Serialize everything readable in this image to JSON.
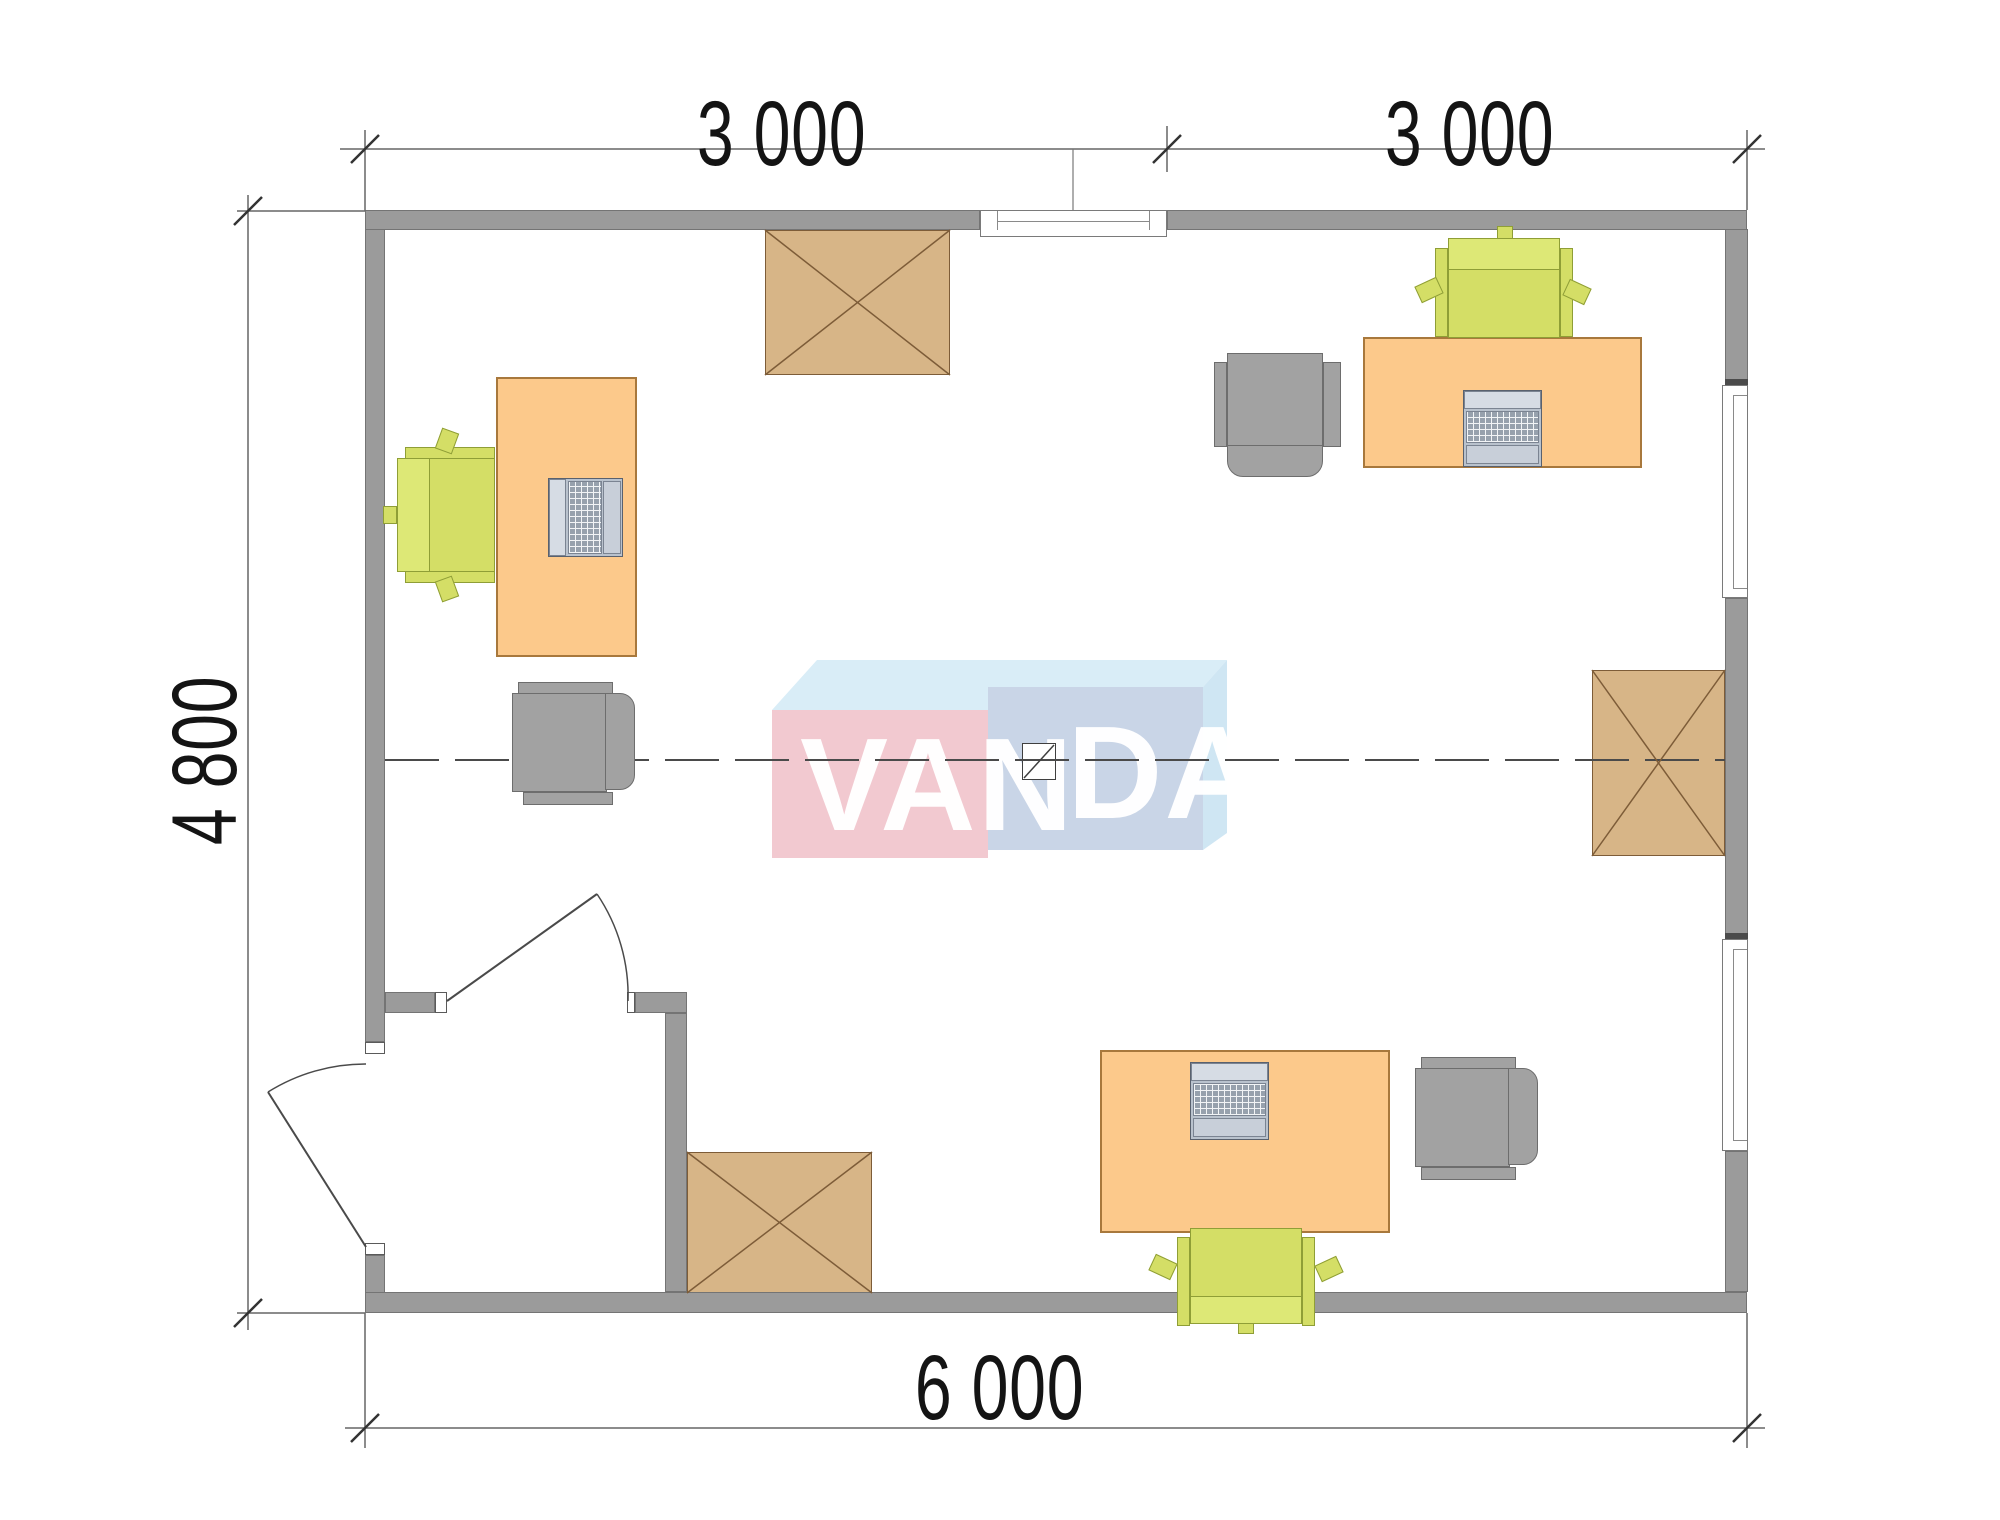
{
  "title": "office-floor-plan",
  "dimension_labels": {
    "top_left": "3 000",
    "top_right": "3 000",
    "left": "4 800",
    "bottom": "6 000"
  },
  "watermark": {
    "left": "VAN",
    "right": "DA"
  },
  "colors": {
    "wall": "#9b9b9b",
    "desk": "#fcc98b",
    "desk_border": "#a8783c",
    "task_chair": "#d4de66",
    "armchair": "#a2a2a2",
    "storage_box": "#d7b587",
    "storage_line": "#7d5c38",
    "logo_pink": "#f2c9d0",
    "logo_blue_front": "#c9d5e7",
    "logo_sky_top": "#d9edf7",
    "dimension_line": "#666666",
    "centerline": "#4a4a4a"
  },
  "inventory": {
    "desks": 3,
    "task_chairs": 3,
    "armchairs": 3,
    "crossed_storage_boxes": 3,
    "windows": 3,
    "doors": 2
  }
}
